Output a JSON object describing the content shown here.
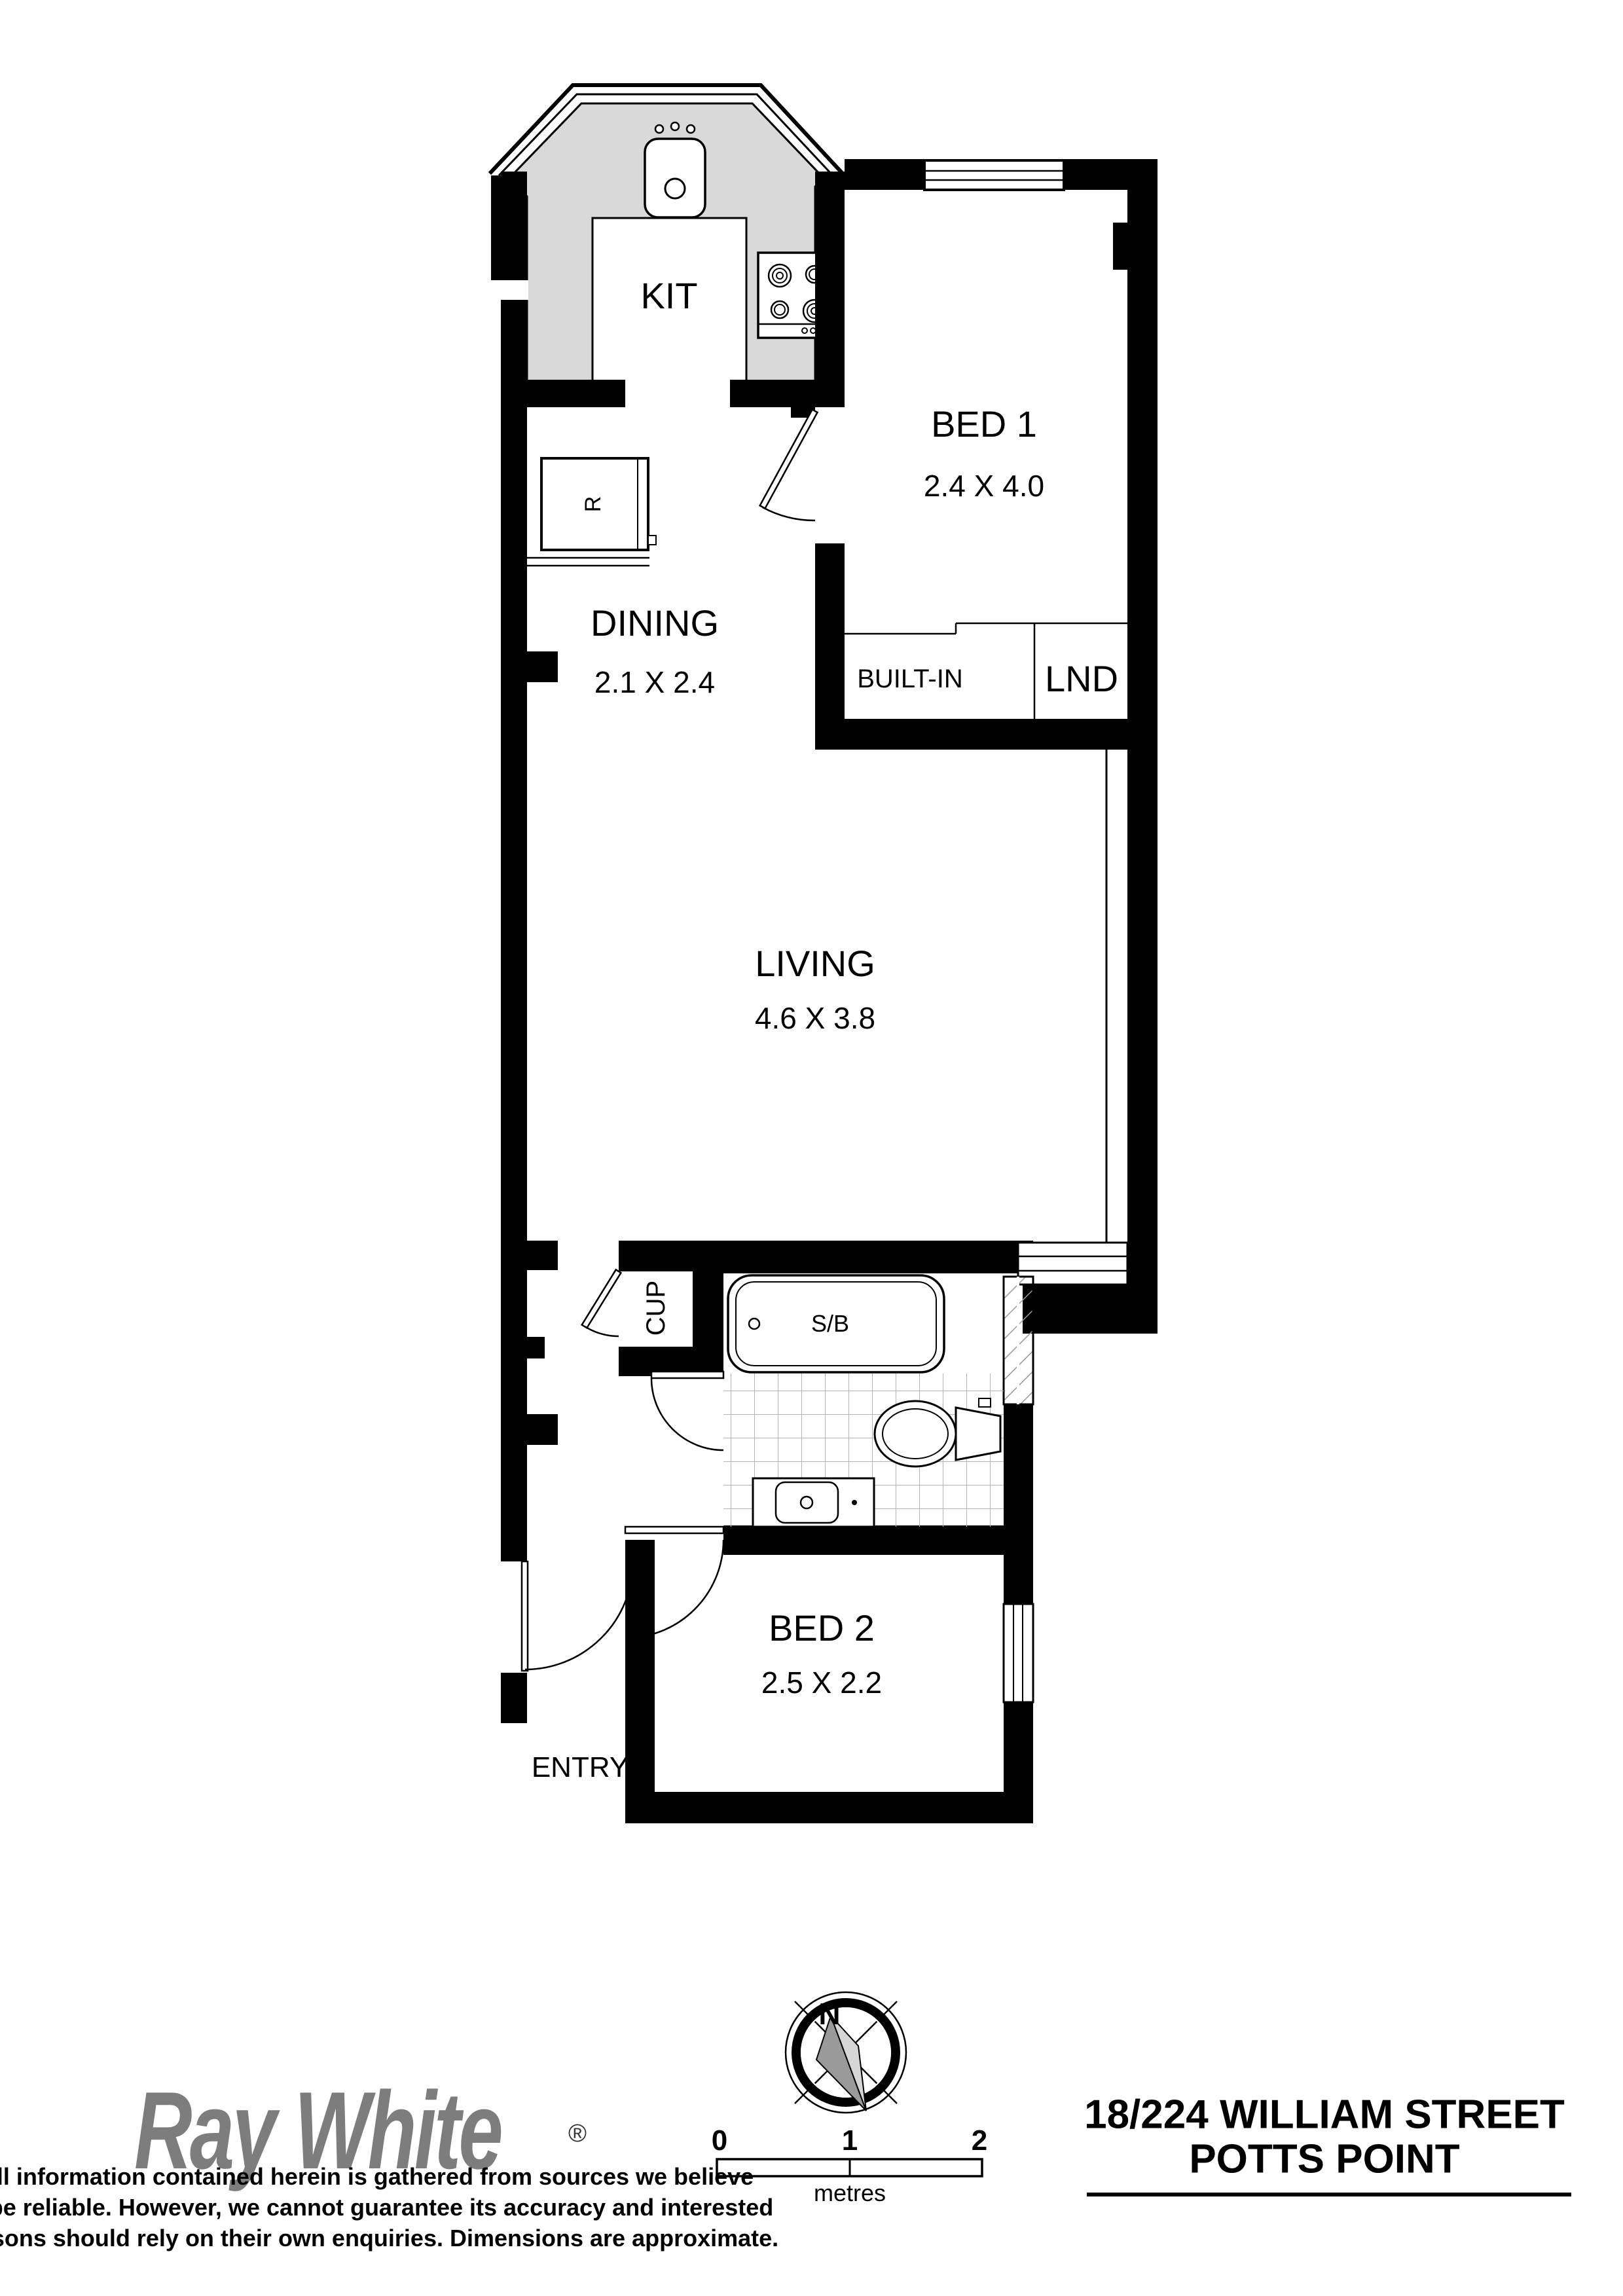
{
  "plan": {
    "rooms": {
      "kitchen": {
        "label": "KIT"
      },
      "bed1": {
        "label": "BED 1",
        "dims": "2.4 X 4.0"
      },
      "dining": {
        "label": "DINING",
        "dims": "2.1 X 2.4"
      },
      "living": {
        "label": "LIVING",
        "dims": "4.6 X 3.8"
      },
      "bed2": {
        "label": "BED 2",
        "dims": "2.5 X 2.2"
      },
      "builtin": {
        "label": "BUILT-IN"
      },
      "laundry": {
        "label": "LND"
      },
      "cupboard": {
        "label": "CUP"
      },
      "entry": {
        "label": "ENTRY"
      }
    },
    "fixtures": {
      "fridge": "R",
      "shower_bath": "S/B"
    }
  },
  "compass": {
    "north": "N"
  },
  "scale_bar": {
    "ticks": [
      "0",
      "1",
      "2"
    ],
    "unit": "metres"
  },
  "branding": {
    "logo": "Ray White",
    "registered": "®",
    "disclaimer_lines": [
      "All information contained herein is gathered from sources we believe",
      "to be reliable. However, we cannot guarantee its accuracy and interested",
      "persons should rely on their own enquiries. Dimensions are approximate."
    ]
  },
  "address": {
    "line1": "18/224 WILLIAM STREET",
    "line2": "POTTS POINT"
  },
  "colors": {
    "walls": "#000000",
    "counter": "#d9d9d9",
    "logo_gray": "#7d7d7d",
    "tile_line": "#b3b3b3",
    "hatch_line": "#999999",
    "needle_dark": "#9a9a9a",
    "needle_light": "#d6d6d6"
  }
}
